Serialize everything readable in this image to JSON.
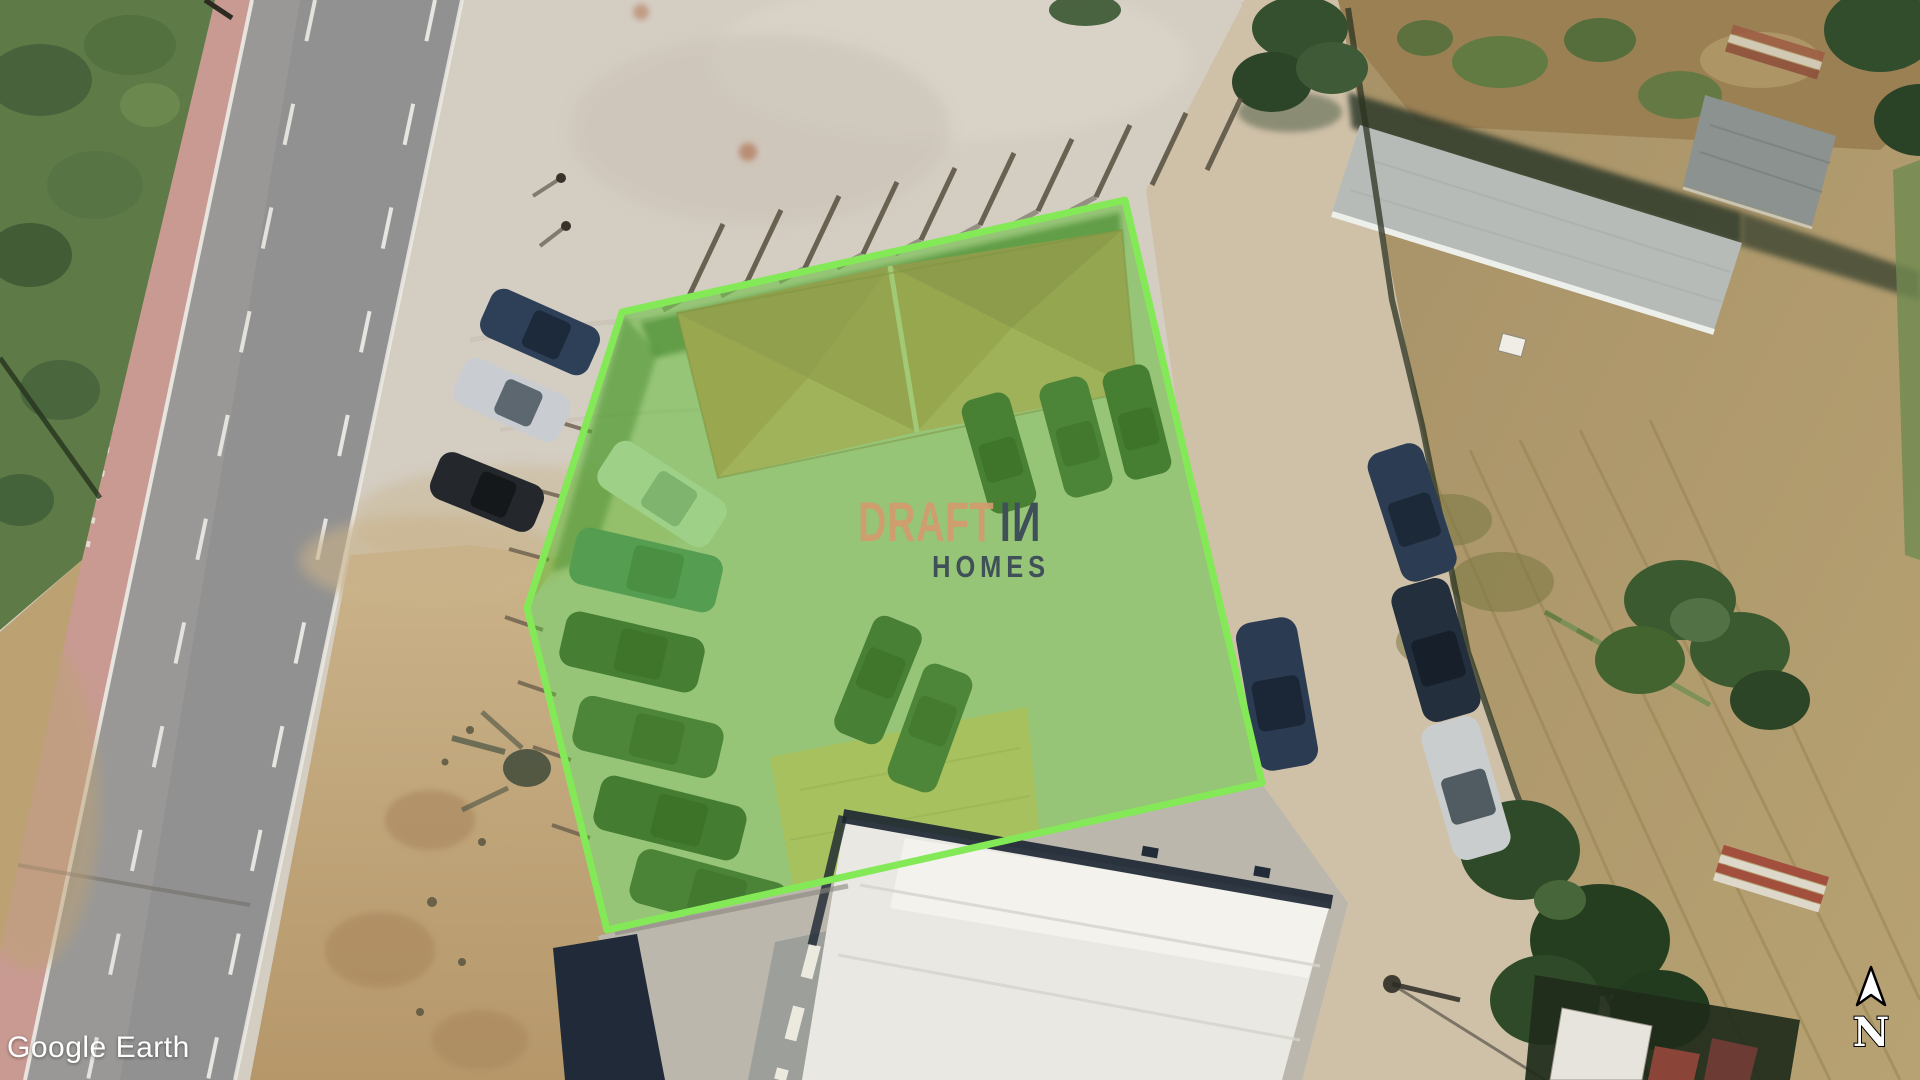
{
  "app": {
    "name": "Google Earth"
  },
  "attribution": {
    "text": "Google Earth"
  },
  "compass": {
    "label": "N"
  },
  "watermark": {
    "brand": "DRAFT",
    "brand2_i": "I",
    "brand2_n": "N",
    "tagline": "HOMES",
    "brand_color": "#d29a6e",
    "dark_color": "#3f5058"
  },
  "parcel": {
    "stroke": "#84e957",
    "fill": "#5abe2d",
    "fill_opacity": 0.5,
    "vertices": [
      [
        1125,
        200
      ],
      [
        1262,
        783
      ],
      [
        607,
        930
      ],
      [
        527,
        608
      ],
      [
        622,
        312
      ]
    ]
  },
  "scene_colors": {
    "concrete_pad": "#d4cdc2",
    "asphalt_road": "#999897",
    "pink_sidewalk": "#c6908a",
    "vegetation": "#5d7a47",
    "dirt": "#c0a478",
    "dry_field": "#ab9668",
    "terracotta_roof": "#d5906e",
    "warehouse_roof": "#e9e8e3",
    "shadow_navy": "#1f2937"
  }
}
